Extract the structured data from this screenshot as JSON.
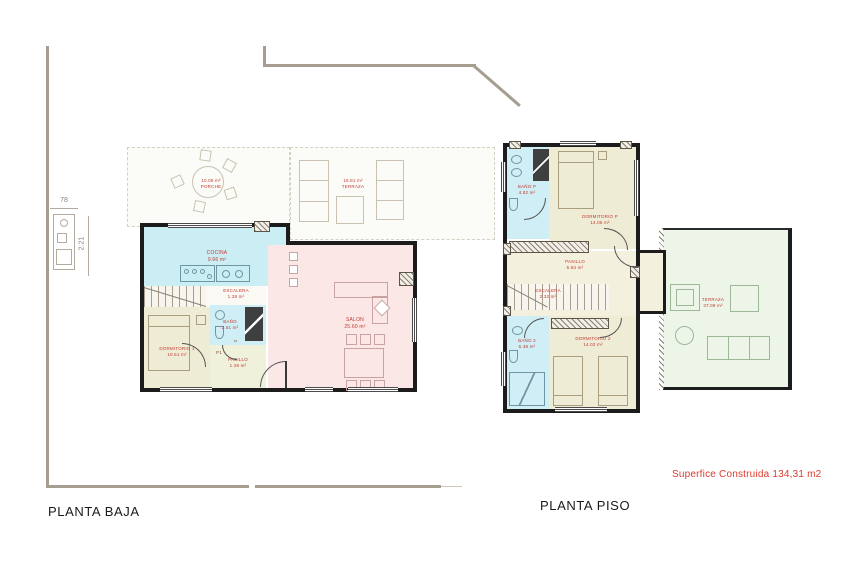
{
  "site": {
    "width_dim": "78",
    "height_dim": "2.21"
  },
  "footer": {
    "surface_note": "Superfice Construida 134,31 m2"
  },
  "colors": {
    "wall": "#1c1c1c",
    "site_line": "#a59e90",
    "label_red": "#c23b32",
    "note_red": "#e0392e",
    "room_cyan": "#cbedf4",
    "room_beige": "#efecd6",
    "room_pink": "#fbe7e6",
    "room_pale_green": "#eff1db",
    "terrace_green": "#edf5e8"
  },
  "plans": {
    "baja": {
      "title": "PLANTA BAJA",
      "rooms": {
        "porche": {
          "area": "10.05 m²",
          "name": "PORCHE"
        },
        "terraza": {
          "area": "16.81 m²",
          "name": "TERRAZA"
        },
        "cocina": {
          "name": "COCINA",
          "area": "9.66 m²"
        },
        "escalera": {
          "name": "ESCALERA",
          "area": "1.28 m²"
        },
        "bano": {
          "name": "BAÑO",
          "area": "2.61 m²"
        },
        "dormitorio": {
          "name": "DORMITORIO 1",
          "area": "10.51 m²"
        },
        "pasillo": {
          "name": "PASILLO",
          "area": "1.28 m²"
        },
        "salon": {
          "name": "SALON",
          "area": "25.60 m²"
        }
      },
      "door_labels": {
        "p1": "P1",
        "two": "2"
      }
    },
    "piso": {
      "title": "PLANTA PISO",
      "rooms": {
        "bano_p": {
          "name": "BAÑO P",
          "area": "4.82 m²"
        },
        "dormitorio_p": {
          "name": "DORMITORIO P",
          "area": "14.05 m²"
        },
        "pasillo": {
          "name": "PASILLO",
          "area": "5.84 m²"
        },
        "escalera": {
          "name": "ESCALERA",
          "area": "2.32 m²"
        },
        "bano_2": {
          "name": "BAÑO 2",
          "area": "5.38 m²"
        },
        "dormitorio_2": {
          "name": "DORMITORIO 2",
          "area": "14.02 m²"
        },
        "terraza": {
          "name": "TERRAZA",
          "area": "37.09 m²"
        }
      }
    }
  }
}
